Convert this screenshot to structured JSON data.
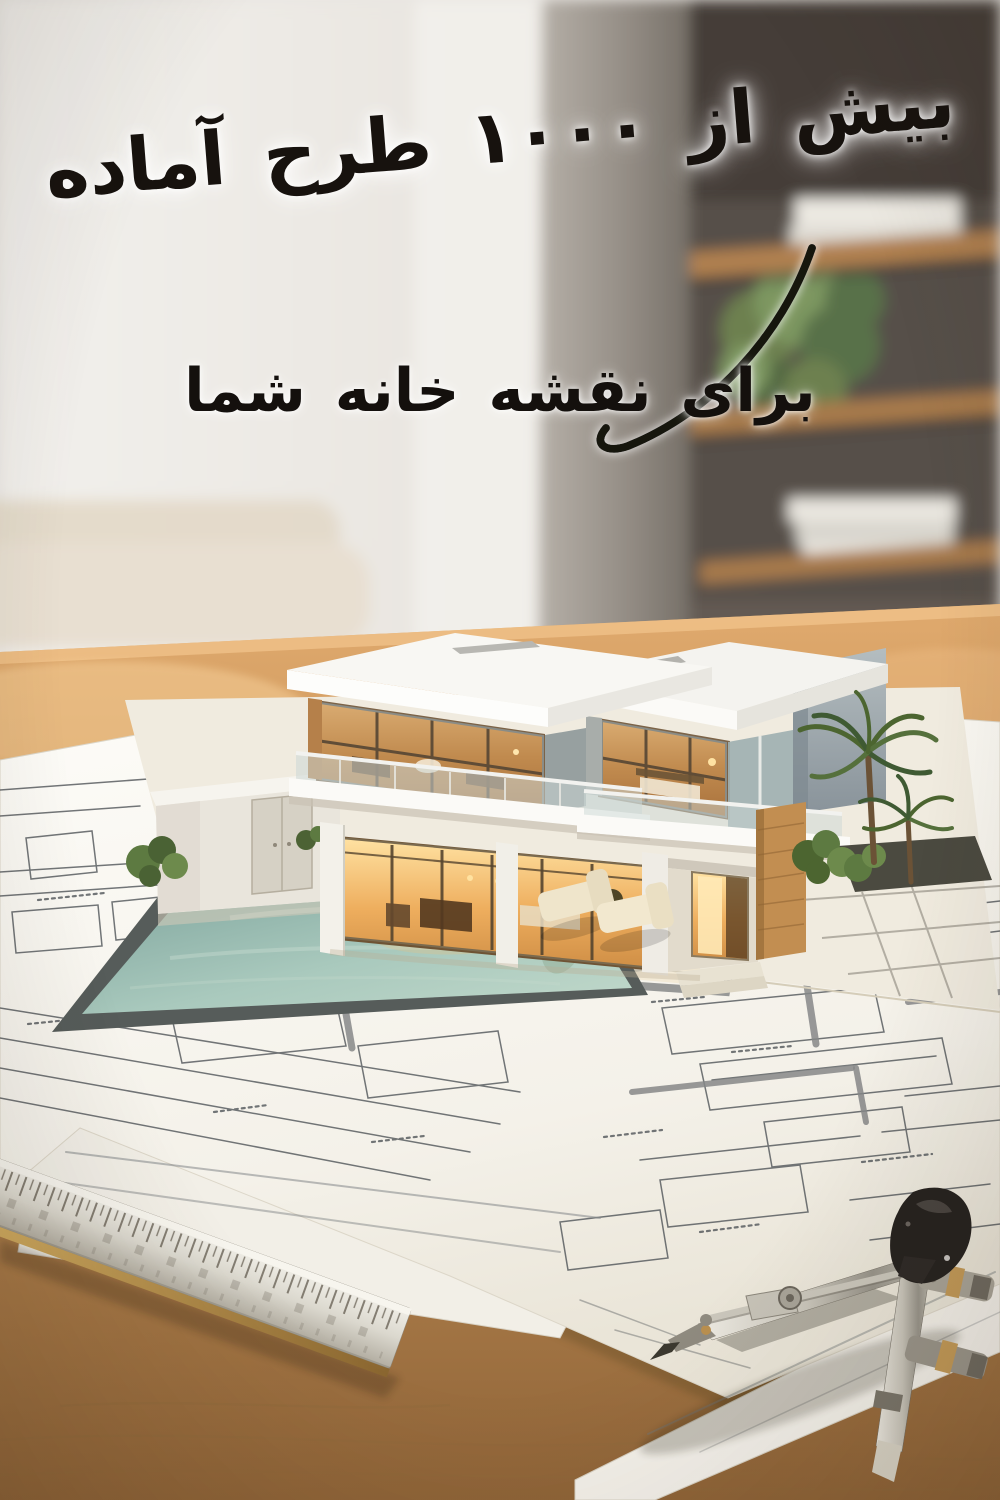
{
  "poster": {
    "headline": "بیش از ۱۰۰۰ طرح آماده",
    "subheadline": "برای نقشه خانه شما"
  },
  "palette": {
    "text": "#17120e",
    "text_glow": "#ffffff",
    "wall_light": "#eae7e2",
    "column_gray": "#8e877f",
    "background_dark": "#57504a",
    "shelf_wood": "#a87c4e",
    "plant_green": "#6d8050",
    "desk_wood": "#c79257",
    "paper_white": "#f7f5ef",
    "sketch_line": "#54585c",
    "house_white": "#f7f6f2",
    "window_glow": "#e8a95c",
    "wood_accent": "#c28e51",
    "pool_water": "#8fb2aa",
    "pool_rim": "#565c5a",
    "lounge_cream": "#ece1c6",
    "metal": "#c9c5bb",
    "brass": "#c39a58",
    "compass_black": "#242120"
  },
  "scene": {
    "tags": [
      "interior-background",
      "bookshelf",
      "wooden-desk",
      "architectural-blueprints",
      "3d-villa-model",
      "swimming-pool",
      "palm-tree",
      "lounge-chairs",
      "metal-ruler",
      "drafting-compass",
      "pen-nib"
    ]
  }
}
